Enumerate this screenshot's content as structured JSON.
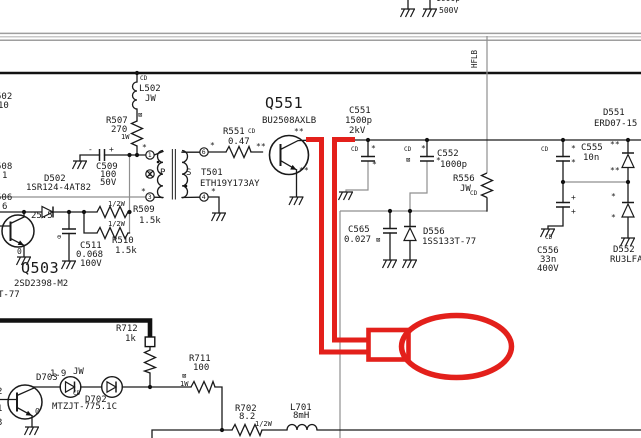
{
  "annotation_color": "#e3201b",
  "net": {
    "hflb": "HFLB"
  },
  "edge_partials": {
    "top_value": "1000p",
    "top_rating": "500V",
    "e1": "502",
    "e2": "10",
    "e3": "508",
    "e4": "1",
    "e5": "506",
    "e6": "6",
    "e7": "T-77",
    "e8": "2",
    "e9": "1",
    "e10": "3"
  },
  "voltage_annotations": {
    "v1": "25.5",
    "v2": "0",
    "v3": "1.9",
    "v4": "0"
  },
  "transformer": {
    "primary": "P",
    "secondary": "S",
    "pins": {
      "p_top": "1",
      "p_mid": "2",
      "p_bot": "3",
      "s_top": "6",
      "s_bot": "4"
    }
  },
  "components": {
    "L502": {
      "ref": "L502",
      "value": "JW"
    },
    "R507": {
      "ref": "R507",
      "value": "270",
      "rating": "1W"
    },
    "C509": {
      "ref": "C509",
      "value": "100",
      "rating": "50V"
    },
    "D502": {
      "ref": "D502",
      "part": "1SR124-4AT82"
    },
    "R509": {
      "ref": "R509",
      "value": "1.5k",
      "rating": "1/2W"
    },
    "R510": {
      "ref": "R510",
      "value": "1.5k",
      "rating": "1/2W"
    },
    "C511": {
      "ref": "C511",
      "value": "0.068",
      "rating": "100V"
    },
    "Q503": {
      "ref": "Q503",
      "part": "2SD2398-M2"
    },
    "T501": {
      "ref": "T501",
      "part": "ETH19Y173AY"
    },
    "R551": {
      "ref": "R551",
      "value": "0.47"
    },
    "Q551": {
      "ref": "Q551",
      "part": "BU2508AXLB"
    },
    "C551": {
      "ref": "C551",
      "value": "1500p",
      "rating": "2kV"
    },
    "C552": {
      "ref": "C552",
      "value": "1000p"
    },
    "R556": {
      "ref": "R556",
      "value": "JW"
    },
    "C565": {
      "ref": "C565",
      "value": "0.027"
    },
    "D556": {
      "ref": "D556",
      "part": "1SS133T-77"
    },
    "C555": {
      "ref": "C555",
      "value": "10n"
    },
    "C556": {
      "ref": "C556",
      "value": "33n",
      "rating": "400V"
    },
    "D551": {
      "ref": "D551",
      "part": "ERD07-15"
    },
    "D552": {
      "ref": "D552",
      "part": "RU3LFA1"
    },
    "R712": {
      "ref": "R712",
      "value": "1k"
    },
    "D703": {
      "ref": "D703",
      "value": "JW"
    },
    "D702": {
      "ref": "D702",
      "part": "MTZJT-775.1C"
    },
    "R711": {
      "ref": "R711",
      "value": "100",
      "rating": "1W"
    },
    "R702": {
      "ref": "R702",
      "value": "8.2",
      "rating": "1/2W"
    },
    "L701": {
      "ref": "L701",
      "value": "8mH"
    }
  },
  "marks": {
    "cd": "CD",
    "box": "⊠",
    "star": "*",
    "star2": "**",
    "plus": "+",
    "minus": "-",
    "cminus": "⊖"
  }
}
